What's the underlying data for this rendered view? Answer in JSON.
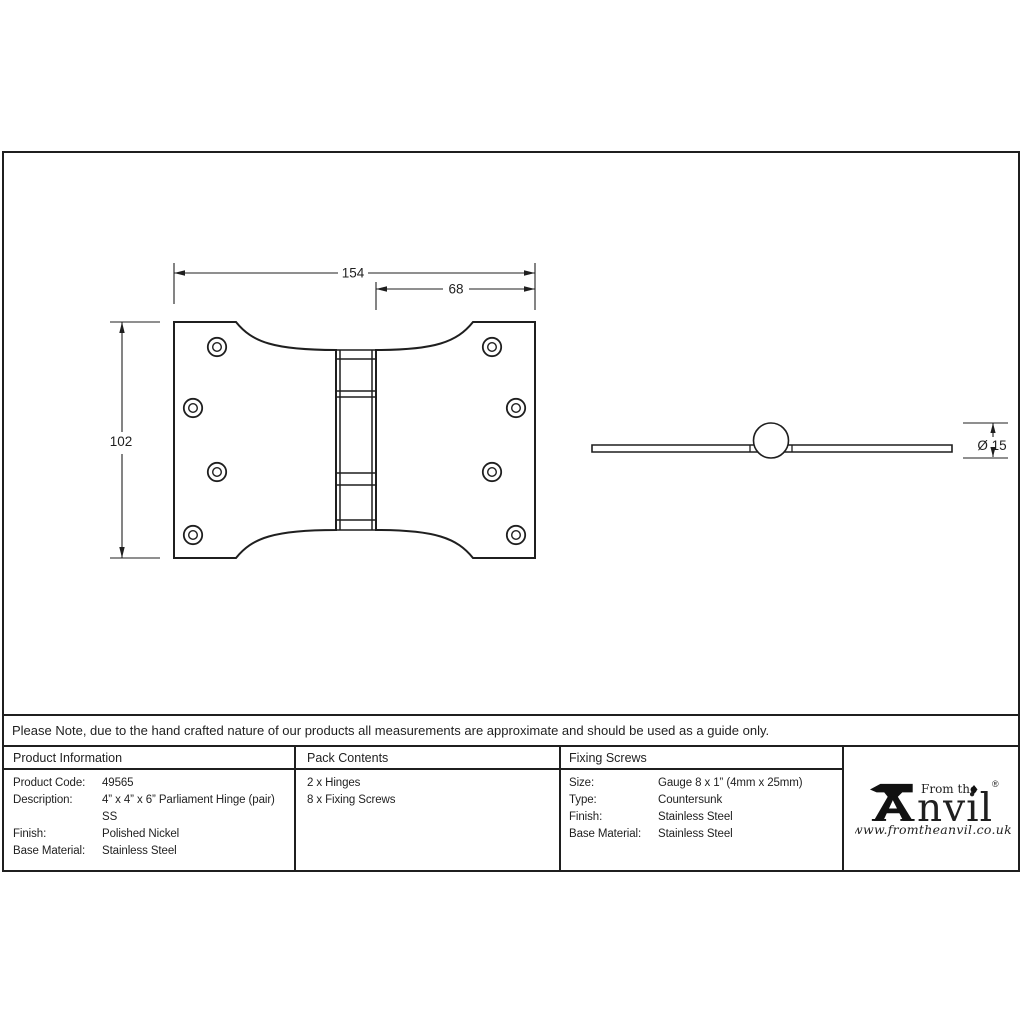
{
  "sheet": {
    "note": "Please Note, due to the hand crafted nature of our products all measurements are approximate and should be used as a guide only.",
    "dimensions": {
      "front_width": "154",
      "front_offset": "68",
      "front_height": "102",
      "knuckle_diameter": "Ø 15"
    },
    "table": {
      "product_info": {
        "header": "Product Information",
        "product_code_label": "Product Code:",
        "product_code": "49565",
        "description_label": "Description:",
        "description_line1": "4” x 4” x 6” Parliament Hinge (pair)",
        "description_line2": "SS",
        "finish_label": "Finish:",
        "finish": "Polished Nickel",
        "base_material_label": "Base Material:",
        "base_material": "Stainless Steel"
      },
      "pack_contents": {
        "header": "Pack Contents",
        "item1": "2 x Hinges",
        "item2": "8 x Fixing Screws"
      },
      "fixing_screws": {
        "header": "Fixing Screws",
        "size_label": "Size:",
        "size": "Gauge 8 x 1” (4mm x 25mm)",
        "type_label": "Type:",
        "type": "Countersunk",
        "finish_label": "Finish:",
        "finish": "Stainless Steel",
        "base_material_label": "Base Material:",
        "base_material": "Stainless Steel"
      }
    },
    "logo": {
      "tagline": "From the",
      "brand_suffix": "nvil",
      "registered_mark": "®",
      "website": "www.fromtheanvil.co.uk"
    },
    "line_color": "#1f1f1f"
  }
}
